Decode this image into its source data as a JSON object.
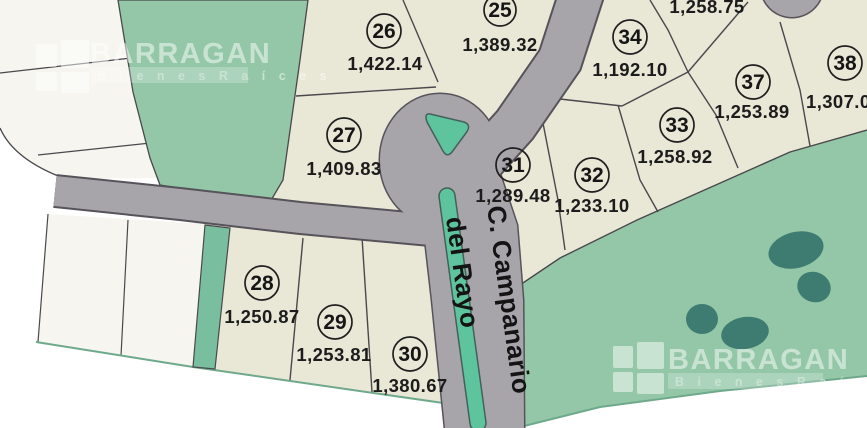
{
  "map": {
    "title": "Lot subdivision plat with street Campanario del Rayo",
    "street": {
      "name": "C. Campanario del Rayo",
      "label_line1": "C. Campanario",
      "label_line2": "del Rayo"
    },
    "lots": [
      {
        "number": "25",
        "area": "1,389.32"
      },
      {
        "number": "26",
        "area": "1,422.14"
      },
      {
        "number": "27",
        "area": "1,409.83"
      },
      {
        "number": "28",
        "area": "1,250.87"
      },
      {
        "number": "29",
        "area": "1,253.81"
      },
      {
        "number": "30",
        "area": "1,380.67"
      },
      {
        "number": "31",
        "area": "1,289.48"
      },
      {
        "number": "32",
        "area": "1,233.10"
      },
      {
        "number": "33",
        "area": "1,258.92"
      },
      {
        "number": "34",
        "area": "1,192.10"
      },
      {
        "number": "37",
        "area": "1,253.89"
      },
      {
        "number": "38",
        "area": "1,307.0"
      },
      {
        "number": "",
        "area": "1,258.75"
      }
    ],
    "watermark": {
      "brand": "BARRAGAN",
      "tagline": "B i e n e s   R a í c e s"
    },
    "colors": {
      "lot_beige": "#e9e7d6",
      "lot_white": "#f6f5ef",
      "green_area": "#94c7a7",
      "green_strip": "#79bf9f",
      "green_median": "#5ec49d",
      "tree_dark_green": "#3e7b71",
      "road_gray": "#a7a4aa",
      "road_outline": "#56535a",
      "parcel_line": "#4a484c",
      "edge_green_line": "#6fa98c"
    }
  }
}
